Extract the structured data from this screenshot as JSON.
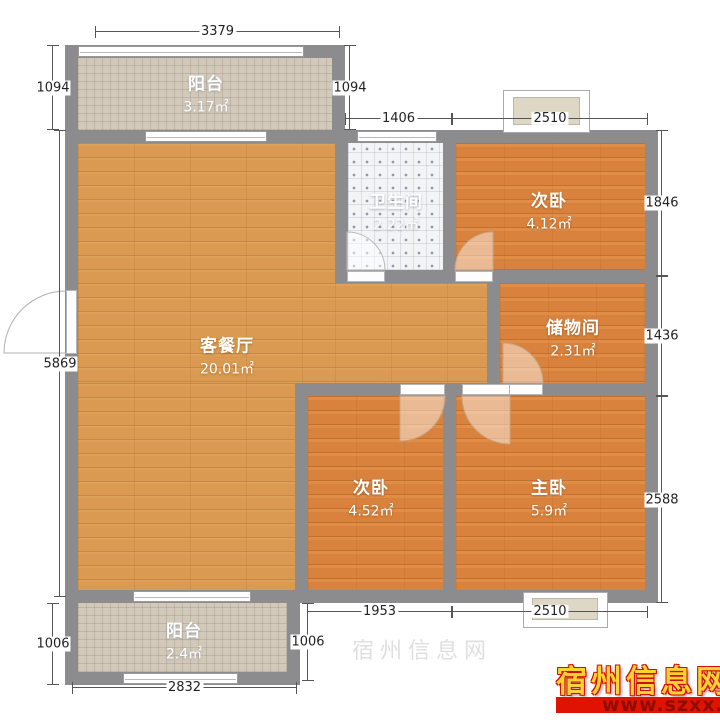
{
  "rooms": [
    {
      "name": "阳台",
      "area": "3.17㎡"
    },
    {
      "name": "卫生间",
      "area": "2.22㎡"
    },
    {
      "name": "次卧",
      "area": "4.12㎡"
    },
    {
      "name": "储物间",
      "area": "2.31㎡"
    },
    {
      "name": "客餐厅",
      "area": "20.01㎡"
    },
    {
      "name": "次卧",
      "area": "4.52㎡"
    },
    {
      "name": "主卧",
      "area": "5.9㎡"
    },
    {
      "name": "阳台",
      "area": "2.4㎡"
    }
  ],
  "dimensions_mm": {
    "balcony_top_width": "3379",
    "balcony_top_height": "1094",
    "balcony_top_height_right": "1094",
    "bathroom_width": "1406",
    "bedroom_top_width": "2510",
    "bedroom_top_height": "1846",
    "storage_height": "1436",
    "master_height": "2588",
    "left_side_height": "5869",
    "balcony_bottom_height": "1006",
    "balcony_bottom_height_right": "1006",
    "bedroom_left_width": "1953",
    "master_width": "2510",
    "balcony_bottom_width": "2832"
  },
  "watermark": {
    "site_name": "宿州信息网",
    "site_url": "www.szxx.com.cn"
  },
  "colors": {
    "wall": "#8c8c8e",
    "living_floor": "#db9a51",
    "bedroom_floor": "#d9823d",
    "balcony_tile": "#d2c9bb",
    "bath_tile": "#f3f4f6",
    "watermark_red": "#e01202",
    "watermark_yellow": "#ffd233"
  }
}
